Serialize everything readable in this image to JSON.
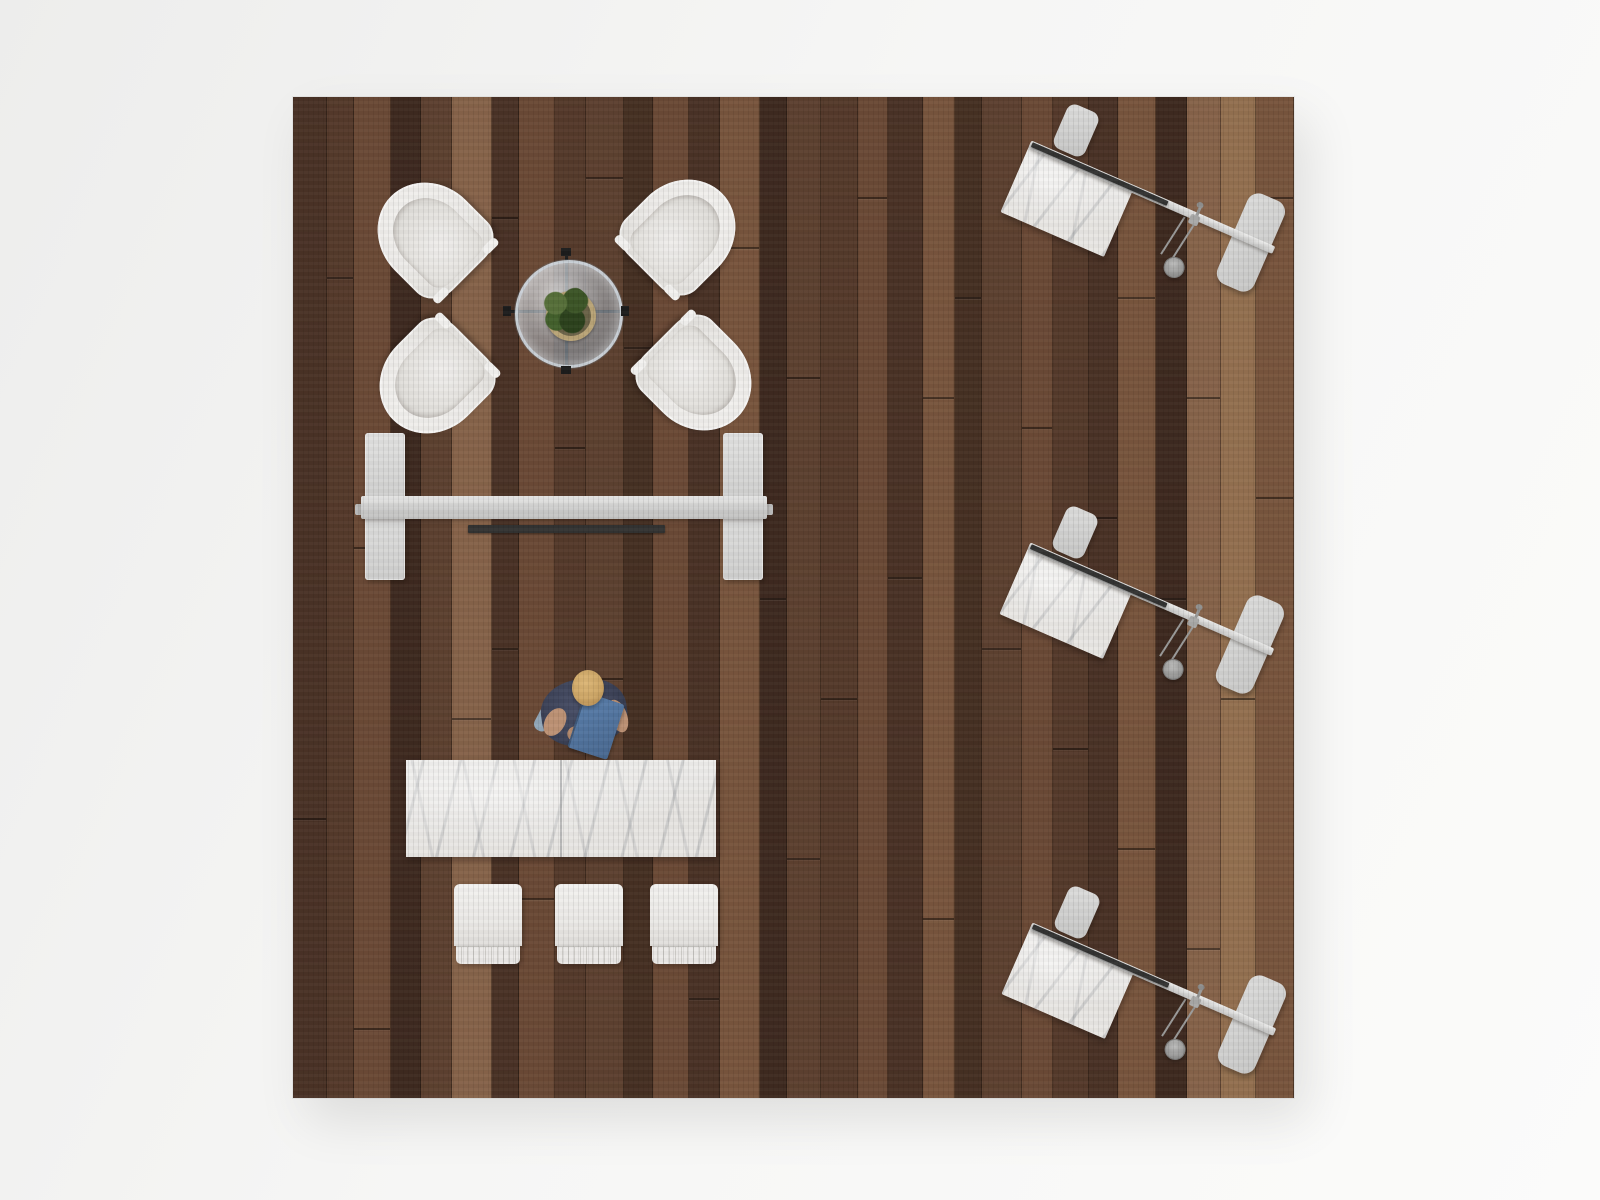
{
  "scene": {
    "floor": {
      "left": 293,
      "top": 97,
      "width": 1001,
      "height": 1001
    },
    "colors": {
      "background": "#f4f4f3",
      "plank_palette": [
        "#5d4130",
        "#4a3226",
        "#6b4a36",
        "#3e2a20",
        "#78553d",
        "#553a2b",
        "#86634a",
        "#463023",
        "#937050"
      ],
      "chair_white": "#f0efec",
      "metal_gray": "#d6d6d5",
      "marble_base": "#eae8e5",
      "monitor_dark": "#333332",
      "glass_tint": "#9fb0ba",
      "shirt_navy": "#3d4358",
      "folder_blue": "#52779f",
      "skin": "#bd9275",
      "hair_blond": "#cda666",
      "shoe_blue": "#92a7b8",
      "plant_green": "#3c5527",
      "pot_tan": "#b9a477"
    },
    "planks": [
      {
        "w": 32,
        "c": 1,
        "s": [
          0.72
        ]
      },
      {
        "w": 26,
        "c": 5,
        "s": [
          0.18
        ]
      },
      {
        "w": 36,
        "c": 2,
        "s": [
          0.45,
          0.93
        ]
      },
      {
        "w": 28,
        "c": 3,
        "s": []
      },
      {
        "w": 30,
        "c": 0,
        "s": [
          0.3
        ]
      },
      {
        "w": 38,
        "c": 6,
        "s": [
          0.62
        ]
      },
      {
        "w": 26,
        "c": 1,
        "s": [
          0.12,
          0.55
        ]
      },
      {
        "w": 34,
        "c": 2,
        "s": [
          0.8
        ]
      },
      {
        "w": 30,
        "c": 5,
        "s": [
          0.35
        ]
      },
      {
        "w": 36,
        "c": 0,
        "s": [
          0.08,
          0.58
        ]
      },
      {
        "w": 28,
        "c": 7,
        "s": [
          0.25
        ]
      },
      {
        "w": 34,
        "c": 2,
        "s": [
          0.7
        ]
      },
      {
        "w": 30,
        "c": 1,
        "s": [
          0.4,
          0.9
        ]
      },
      {
        "w": 38,
        "c": 4,
        "s": [
          0.15
        ]
      },
      {
        "w": 26,
        "c": 3,
        "s": [
          0.5
        ]
      },
      {
        "w": 32,
        "c": 0,
        "s": [
          0.28,
          0.76
        ]
      },
      {
        "w": 36,
        "c": 5,
        "s": [
          0.6
        ]
      },
      {
        "w": 28,
        "c": 2,
        "s": [
          0.1
        ]
      },
      {
        "w": 34,
        "c": 1,
        "s": [
          0.48
        ]
      },
      {
        "w": 30,
        "c": 4,
        "s": [
          0.3,
          0.82
        ]
      },
      {
        "w": 26,
        "c": 7,
        "s": [
          0.2
        ]
      },
      {
        "w": 38,
        "c": 0,
        "s": [
          0.55
        ]
      },
      {
        "w": 30,
        "c": 2,
        "s": [
          0.33,
          0.88
        ]
      },
      {
        "w": 34,
        "c": 5,
        "s": [
          0.65
        ]
      },
      {
        "w": 28,
        "c": 1,
        "s": [
          0.42
        ]
      },
      {
        "w": 36,
        "c": 4,
        "s": [
          0.2,
          0.75
        ]
      },
      {
        "w": 30,
        "c": 3,
        "s": [
          0.5
        ]
      },
      {
        "w": 32,
        "c": 6,
        "s": [
          0.3,
          0.85
        ]
      },
      {
        "w": 34,
        "c": 8,
        "s": [
          0.6
        ]
      },
      {
        "w": 36,
        "c": 4,
        "s": [
          0.1,
          0.4
        ]
      }
    ],
    "lounge": {
      "coffee_table": {
        "cx": 273,
        "cy": 214,
        "glass_d": 102,
        "frame_len": 118,
        "pot_d": 40,
        "plant_d": 52
      },
      "armchairs": [
        {
          "cx": 137,
          "cy": 138,
          "rot": -45
        },
        {
          "cx": 390,
          "cy": 135,
          "rot": 45
        },
        {
          "cx": 139,
          "cy": 284,
          "rot": -135
        },
        {
          "cx": 406,
          "cy": 281,
          "rot": 135
        }
      ],
      "chair_w": 100,
      "chair_h": 110
    },
    "console": {
      "left_panel": {
        "x": 72,
        "y": 336,
        "w": 40,
        "h": 147
      },
      "right_panel": {
        "x": 430,
        "y": 336,
        "w": 40,
        "h": 147
      },
      "crossbar": {
        "x": 68,
        "y": 399,
        "w": 406,
        "h": 23
      },
      "nubs": [
        {
          "x": 62,
          "y": 407,
          "w": 8,
          "h": 11
        },
        {
          "x": 472,
          "y": 407,
          "w": 8,
          "h": 11
        }
      ],
      "screen_strip": {
        "x": 175,
        "y": 428,
        "w": 197,
        "h": 8
      }
    },
    "person": {
      "x": 230,
      "y": 560,
      "parts": [
        {
          "name": "person-shadow",
          "cls": "p-part",
          "x": 14,
          "y": 34,
          "w": 86,
          "h": 62,
          "rot": -8,
          "style": "border-radius:50%;background:radial-gradient(circle, rgba(0,0,0,.20) 0%, rgba(0,0,0,0) 70%);"
        },
        {
          "name": "person-shoe",
          "cls": "p-part",
          "x": 14,
          "y": 48,
          "w": 15,
          "h": 27,
          "rot": 28,
          "style": "border-radius:7px;background:#92a7b8;"
        },
        {
          "name": "person-torso",
          "cls": "p-part",
          "x": 18,
          "y": 22,
          "w": 86,
          "h": 66,
          "rot": -8,
          "style": "border-radius:46% 46% 42% 42%;background:radial-gradient(circle at 45% 40%, #4a5068 0%, #3d4358 55%, #30364a 100%);"
        },
        {
          "name": "person-arm-left",
          "cls": "p-part",
          "x": 22,
          "y": 50,
          "w": 20,
          "h": 30,
          "rot": 30,
          "style": "border-radius:50%;background:#bd9275;"
        },
        {
          "name": "person-arm-right",
          "cls": "p-part",
          "x": 86,
          "y": 42,
          "w": 18,
          "h": 34,
          "rot": -20,
          "style": "border-radius:50%;background:#bd9275;"
        },
        {
          "name": "person-forearm",
          "cls": "p-part",
          "x": 44,
          "y": 66,
          "w": 48,
          "h": 15,
          "rot": -12,
          "style": "border-radius:8px;background:#b78c6f;"
        },
        {
          "name": "person-folder",
          "cls": "p-part",
          "x": 52,
          "y": 40,
          "w": 40,
          "h": 58,
          "rot": 18,
          "style": "border-radius:3px;background:linear-gradient(135deg,#5b80ad 0%,#49688f 100%);border-left:2px solid #3d587a;box-shadow:1px 2px 3px rgba(0,0,0,.3);"
        },
        {
          "name": "person-head",
          "cls": "p-part",
          "x": 49,
          "y": 13,
          "w": 32,
          "h": 36,
          "rot": 0,
          "style": "border-radius:50%;background:radial-gradient(circle at 42% 35%, #dcb677 0%, #cda666 55%, #a9814a 100%);box-shadow:0 2px 4px rgba(0,0,0,.3);"
        }
      ]
    },
    "dining": {
      "table": {
        "x": 113,
        "y": 663,
        "w": 310,
        "h": 97
      },
      "stool_y": 787,
      "stool_w": 68,
      "stool_body_h": 62,
      "stool_fringe_h": 17,
      "stool_xs": [
        161,
        262,
        357
      ]
    },
    "workstations": {
      "rot_deg": 23.5,
      "origins": [
        {
          "x": 736,
          "y": 49
        },
        {
          "x": 735,
          "y": 451
        },
        {
          "x": 737,
          "y": 831
        }
      ],
      "layout": {
        "beam": {
          "x": 0,
          "y": -6,
          "w": 266,
          "h": 8
        },
        "strip": {
          "x": 2,
          "y": -5,
          "w": 148,
          "h": 5
        },
        "marble": {
          "x": 0,
          "y": 0,
          "w": 113,
          "h": 72
        },
        "stool": {
          "x": 20,
          "y": -57,
          "w": 34,
          "h": 48
        },
        "bench": {
          "x": 222,
          "y": -49,
          "w": 40,
          "h": 98
        },
        "clamp": {
          "x": 176,
          "y": -3,
          "w": 10,
          "h": 10
        },
        "pin": {
          "x": 180,
          "y": -14,
          "w": 3,
          "h": 11
        },
        "pin_ball": {
          "x": 177,
          "y": -17,
          "w": 7,
          "h": 6
        },
        "rods": {
          "x": 170,
          "y": 4,
          "w": 10,
          "h": 44,
          "lean": 9
        },
        "disc": {
          "x": 171,
          "y": 43,
          "w": 19,
          "h": 19
        }
      }
    }
  }
}
